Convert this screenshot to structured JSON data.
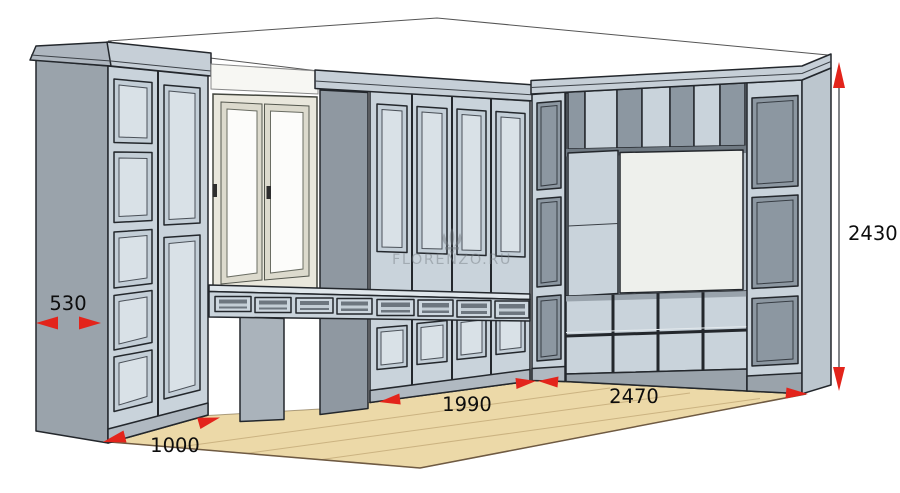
{
  "watermark": {
    "icon_name": "fleur-de-lis-icon",
    "text": "FLORENZO.RU"
  },
  "dimensions": {
    "d530": {
      "label": "530"
    },
    "d1000": {
      "label": "1000"
    },
    "d1990": {
      "label": "1990"
    },
    "d2470": {
      "label": "2470"
    },
    "d2430": {
      "label": "2430"
    }
  },
  "colors": {
    "accent_red": "#e3241b",
    "dim_text": "#0d0d0d",
    "outline": "#23272c",
    "cabinet_face": "#c9d3db",
    "cabinet_face_light": "#d9e1e7",
    "panel_frame": "#c3ced7",
    "panel_dark": "#8c97a1",
    "side_gray": "#9aa3ab",
    "side_dark": "#8f98a1",
    "crown": "#c6cfd7",
    "plinth": "#b0b9c1",
    "floor_wood": "#ecd9a8",
    "floor_edge": "#6f5a42",
    "window_frame": "#e9e7dc",
    "glass_white": "#fcfcfa",
    "niche_white": "#eef0ec",
    "wall_white": "#ffffff",
    "watermark_gray": "#747b82"
  }
}
